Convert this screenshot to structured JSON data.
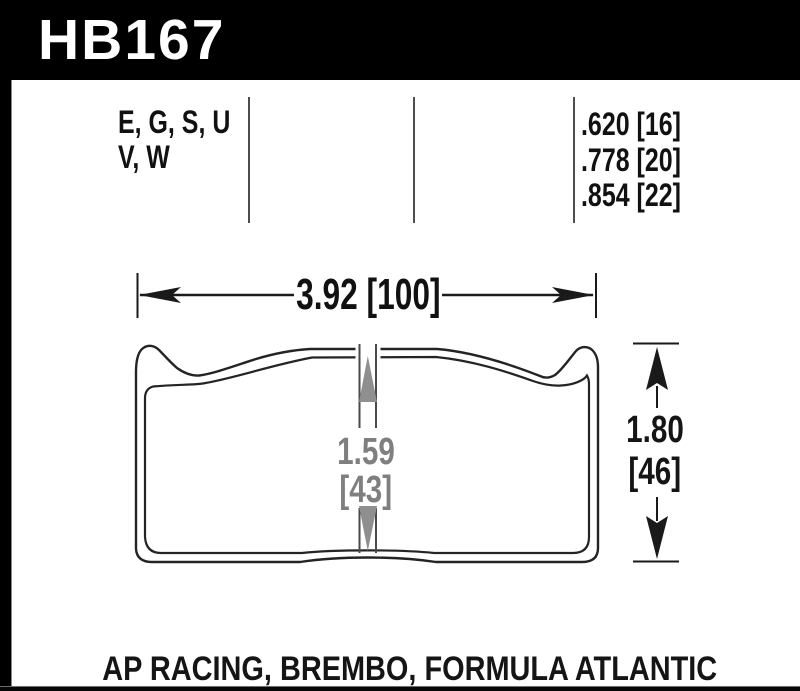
{
  "header": {
    "part_number": "HB167"
  },
  "spec_row": {
    "compounds": [
      "E, G, S, U",
      "V, W"
    ],
    "thicknesses": [
      ".620 [16]",
      ".778 [20]",
      ".854 [22]"
    ]
  },
  "dimensions": {
    "width": "3.92 [100]",
    "inner_height_in": "1.59",
    "inner_height_mm": "[43]",
    "overall_height_in": "1.80",
    "overall_height_mm": "[46]"
  },
  "footer": {
    "applications": "AP RACING, BREMBO, FORMULA ATLANTIC"
  },
  "colors": {
    "header_bg": "#000000",
    "header_text": "#ffffff",
    "line_black": "#1a1a1a",
    "dimension_gray": "#7f7f7f"
  }
}
